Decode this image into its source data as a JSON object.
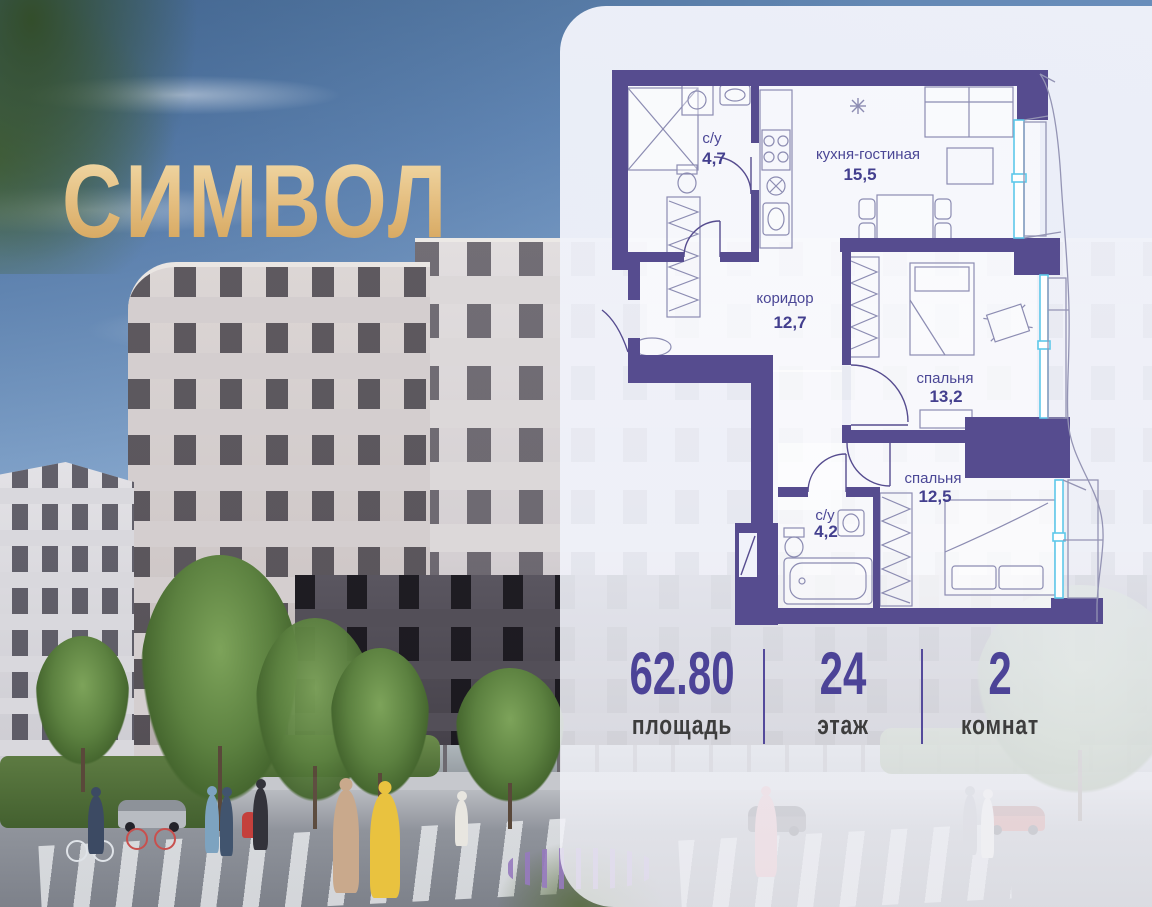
{
  "brand": {
    "logo_text": "СИМВОЛ"
  },
  "floor_plan": {
    "rooms": [
      {
        "id": "bathroom-1",
        "name": "с/у",
        "area": "4,7"
      },
      {
        "id": "kitchen-living",
        "name": "кухня-гостиная",
        "area": "15,5"
      },
      {
        "id": "corridor",
        "name": "коридор",
        "area": "12,7"
      },
      {
        "id": "bedroom-1",
        "name": "спальня",
        "area": "13,2"
      },
      {
        "id": "bathroom-2",
        "name": "с/у",
        "area": "4,2"
      },
      {
        "id": "bedroom-2",
        "name": "спальня",
        "area": "12,5"
      }
    ],
    "wall_color": "#564c8f",
    "window_color": "#5ec8ea"
  },
  "stats": {
    "area": {
      "value": "62.80",
      "label": "площадь"
    },
    "floor": {
      "value": "24",
      "label": "этаж"
    },
    "rooms": {
      "value": "2",
      "label": "комнат"
    }
  },
  "colors": {
    "logo_gold": "#e6c184",
    "stat_number": "#4c4397",
    "stat_label": "#3d3d3d",
    "panel_bg": "#f0f2fa"
  }
}
